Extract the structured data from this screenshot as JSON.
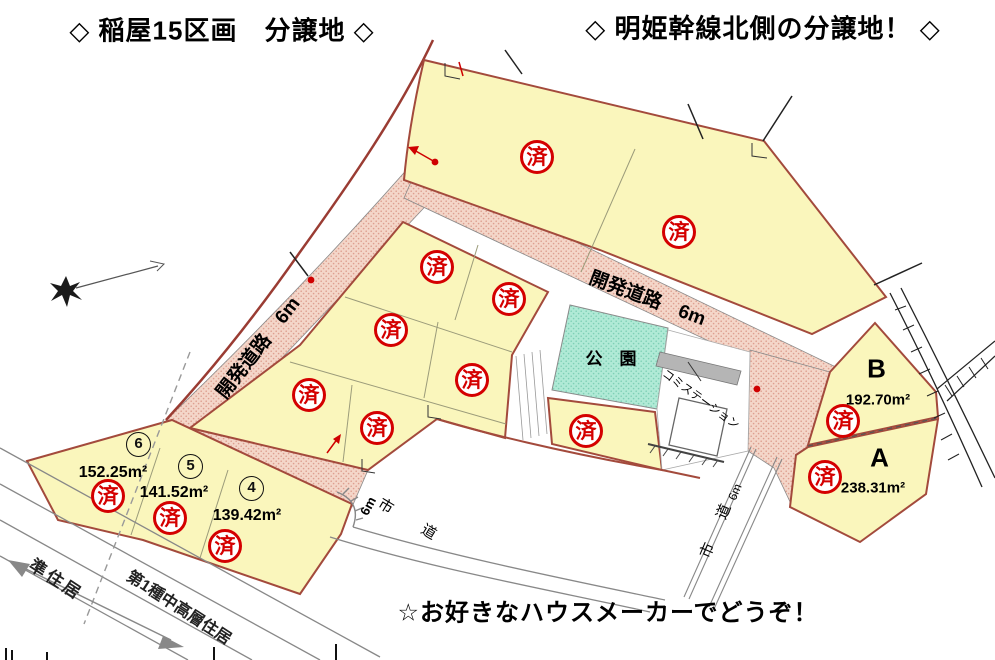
{
  "titles": {
    "left": "◇ 稲屋15区画　分譲地 ◇",
    "right": "◇ 明姫幹線北側の分譲地！ ◇"
  },
  "note": "☆お好きなハウスメーカーでどうぞ！",
  "map": {
    "sold_label": "済",
    "park_label": "公　園",
    "trash_station_label": "コミステーション",
    "roads": {
      "dev_road_left": "開発道路　6m",
      "dev_road_right": "開発道路　6m",
      "city_road_bottom": "市　道",
      "city_road_bottom_width": "6m",
      "city_road_right": "市　道",
      "city_road_right_width": "6m"
    },
    "zones": {
      "semi_residential": "準住居",
      "first_class_mid_high": "第1種中高層住居"
    },
    "lots": [
      {
        "id": "6",
        "area": "152.25m²"
      },
      {
        "id": "5",
        "area": "141.52m²"
      },
      {
        "id": "4",
        "area": "139.42m²"
      },
      {
        "id": "B",
        "area": "192.70m²"
      },
      {
        "id": "A",
        "area": "238.31m²"
      }
    ]
  }
}
